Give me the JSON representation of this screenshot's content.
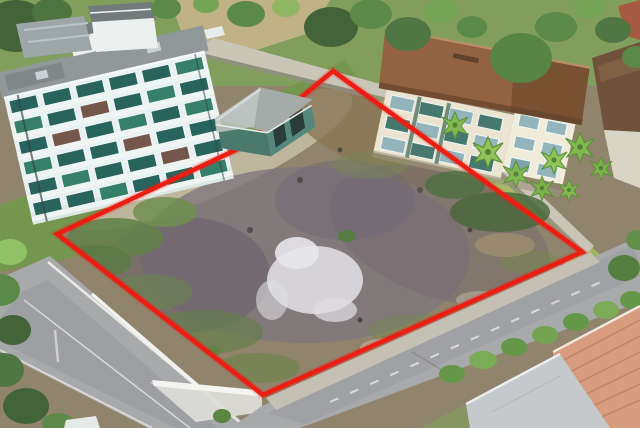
{
  "scene": {
    "description": "aerial-drone-photo-of-vacant-land-plot-outlined-in-red",
    "boundary": {
      "points": "333,71 582,252 263,395 57,234 240,148",
      "stroke_width": 4.6
    },
    "colors": {
      "red": "#ee1408",
      "dirt": "#8d7f66",
      "dirtMauve": "#7a7078",
      "dirtDark": "#615a64",
      "dirtBrown": "#86704f",
      "dirtLight": "#c6bca2",
      "pale": "#dfdce2",
      "grass": "#6f9246",
      "grassBright": "#9ab35c",
      "grassDark": "#4c7036",
      "treeDark": "#3c5c30",
      "treeMid": "#558440",
      "treeLight": "#6fa24e",
      "treeYellow": "#8db45c",
      "road": "#a6a6a8",
      "roadDark": "#97979b",
      "curb": "#e9e9e5",
      "sidewalk": "#c3bfb1",
      "wall": "#c9c4b5",
      "wallShadow": "#8f8a7e",
      "aptWall": "#e9f1f2",
      "aptShade": "#d4e2e5",
      "aptBase": "#dde7e4",
      "aptRoof": "#8d9496",
      "winTeal": "#1f5c55",
      "winTeal2": "#2e7a62",
      "winFrame": "#f4f9f9",
      "bldRoof": "#905c38",
      "bldRoofDark": "#6f4527",
      "bldWall": "#ece4d0",
      "bldWallLight": "#f2ecda",
      "trimGreen": "#3c6a58",
      "winBlue": "#8fb2b8",
      "shedRoof": "#a3a8a6",
      "shedRoofLight": "#bfc4c2",
      "shedWall": "#447467",
      "shedDark": "#22342f",
      "palm": "#7eb648",
      "palmDark": "#558a32",
      "hedge": "#5f9340",
      "terracotta": "#d9997a",
      "terraLine": "#bc7d5e",
      "grayRoof": "#c6c8ca",
      "brownRoof": "#6b4a33",
      "redRoofSmall": "#a55238",
      "concrete": "#d8d4c6",
      "white": "#eef2f0"
    }
  }
}
